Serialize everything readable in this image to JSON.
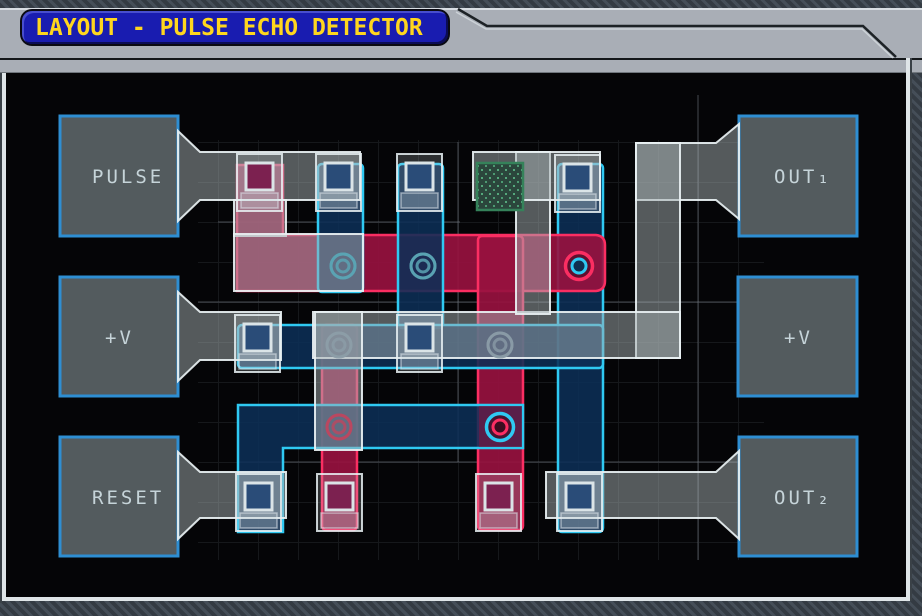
{
  "window": {
    "title": "LAYOUT - PULSE ECHO DETECTOR"
  },
  "pads": {
    "left": [
      {
        "id": "pulse",
        "label": "PULSE"
      },
      {
        "id": "vplus-left",
        "label": "+V"
      },
      {
        "id": "reset",
        "label": "RESET"
      }
    ],
    "right": [
      {
        "id": "out1",
        "label": "OUT₁"
      },
      {
        "id": "vplus-right",
        "label": "+V"
      },
      {
        "id": "out2",
        "label": "OUT₂"
      }
    ]
  },
  "palette": {
    "board_bg": "#050507",
    "hatch_light": "#454e58",
    "hatch_dark": "#343b43",
    "header_silver": "#a9aeb6",
    "title_bg": "#191cb0",
    "title_text": "#ffd61e",
    "pad_fill": "#535b5e",
    "pad_border": "#2e8ed2",
    "pad_label": "#c6d4d9",
    "metal_border": "#e9f1f3",
    "n_fill": "#0c2f57",
    "n_border": "#2fc9f2",
    "p_fill": "#97113f",
    "p_border": "#fb2e62",
    "gate_border": "#dbe4e7",
    "gate_blue": "#2a4c78",
    "gate_red": "#7c2150",
    "green_cell_border": "#35825a",
    "green_cell_fill": "#2b463c",
    "green_cell_dot": "#55a87c"
  }
}
